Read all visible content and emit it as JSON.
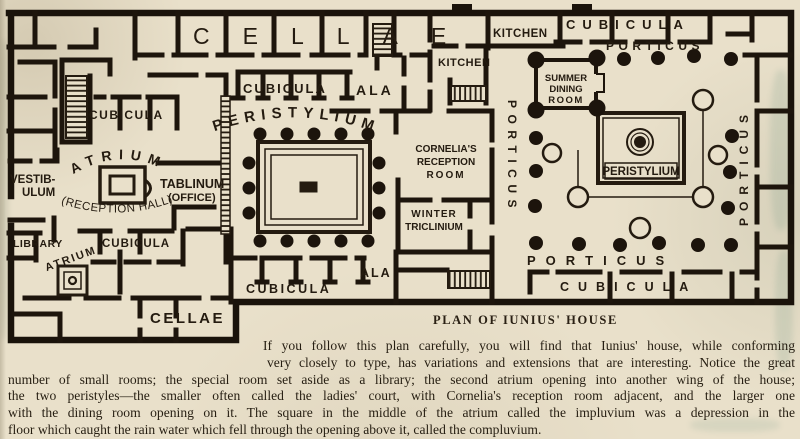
{
  "plan": {
    "labels": {
      "cellae_top": "CELLAE",
      "cellae_bottom": "CELLAE",
      "cubicula_upper_left": "CUBICULA",
      "cubicula_top_middle": "CUBICULA",
      "cubicula_mid_left": "CUBICULA",
      "cubicula_bottom_middle": "CUBICULA",
      "cubicula_top_right": "CUBICULA",
      "cubicula_bottom_right": "CUBICULA",
      "ala_top": "ALA",
      "ala_bottom": "ALA",
      "peristylium_main": "PERISTYLIUM",
      "peristylium_right": "PERISTYLIUM",
      "atrium_main": "ATRIUM",
      "atrium_main_subtitle": "(RECEPTION HALL)",
      "atrium_small": "ATRIUM",
      "vestibulum": [
        "VESTIB-",
        "ULUM"
      ],
      "tablinum": [
        "TABLINUM",
        "(OFFICE)"
      ],
      "library": "LIBRARY",
      "kitchen_upper": "KITCHEN",
      "kitchen_lower": "KITCHEN",
      "cornelias_reception_room": [
        "CORNELIA'S",
        "RECEPTION",
        "ROOM"
      ],
      "winter_triclinium": [
        "WINTER",
        "TRICLINIUM"
      ],
      "summer_dining_room": [
        "SUMMER",
        "DINING",
        "ROOM"
      ],
      "porticus_top": "PORTICUS",
      "porticus_bottom": "PORTICUS",
      "porticus_left_vertical": "PORTICUS",
      "porticus_right_vertical": "PORTICUS"
    }
  },
  "caption": {
    "title": "PLAN OF IUNIUS' HOUSE"
  },
  "paragraph": {
    "lines": [
      "If you follow this plan carefully, you will find that Iunius' house, while conforming",
      "very closely to type, has variations and extensions that are interesting. Notice the great",
      "number of small rooms; the special room set aside as a library; the second atrium opening into another wing of the house;",
      "the two peristyles—the smaller often called the ladies' court, with Cornelia's reception room adjacent, and the larger one",
      "with the dining room opening on it. The square in the middle of the atrium called the impluvium was a depression in the",
      "floor which caught the rain water which fell through the opening above it, called the compluvium."
    ]
  },
  "colors": {
    "paper": "#e9e0ca",
    "ink": "#241b10"
  }
}
